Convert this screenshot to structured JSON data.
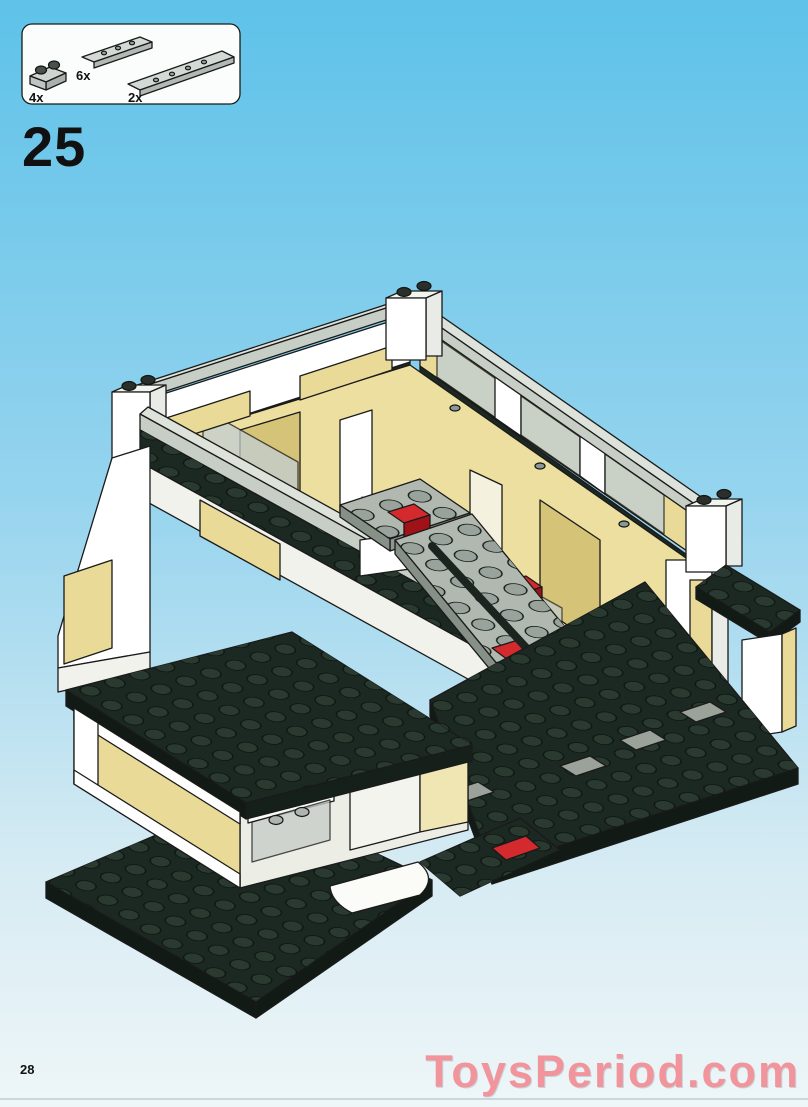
{
  "step": {
    "number": "25"
  },
  "parts_panel": {
    "items": [
      {
        "name": "plate-1x2-with-knobs",
        "qty": "4x"
      },
      {
        "name": "plate-1x8",
        "qty": "6x"
      },
      {
        "name": "plate-1x10",
        "qty": "2x"
      }
    ]
  },
  "footer": {
    "page_number": "28",
    "watermark": "ToysPeriod.com"
  },
  "illustration": {
    "description": "isometric LEGO building step: L-shaped dark baseplates, tan walls with white corner pillars, gray wall copings, translucent windows, central gray staircase with red elements, lower-left room with display cases"
  },
  "colors": {
    "sky_top": "#5ec2e9",
    "sky_mid": "#96d4ee",
    "sky_low": "#d6ebf3",
    "sky_bottom": "#eef6f8",
    "panel": "#fbfdfd",
    "text": "#111111",
    "watermark": "#f2949c",
    "tan": "#e9db97",
    "tan_shade": "#d5c377",
    "white_brick": "#ffffff",
    "white_shade": "#e9ebe6",
    "coping": "#c6cec5",
    "coping_top": "#dde3da",
    "plate_dark": "#1c2822",
    "plate_side": "#111a14",
    "stud_dark": "#2b3a31",
    "ramp": "#b0b8af",
    "ramp_side": "#8f978f",
    "stud_gray": "#9aa39b",
    "red": "#d42a2e",
    "red_dark": "#a01217",
    "window": "#c2ced2",
    "pink": "#e0559d",
    "yellow": "#e6d23c",
    "outline": "#1a1a1a"
  }
}
